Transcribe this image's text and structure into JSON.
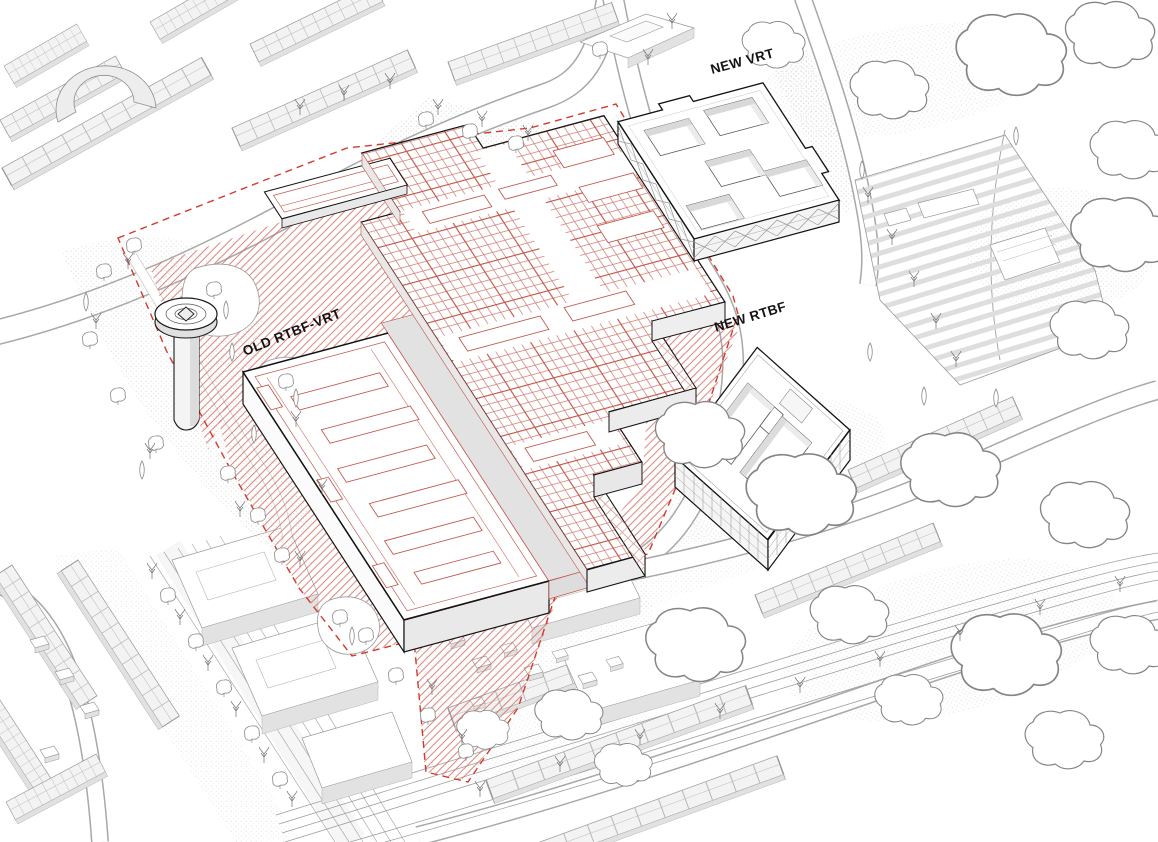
{
  "drawing": {
    "labels": {
      "new_vrt": "NEW VRT",
      "old_rtbf_vrt": "OLD RTBF-VRT",
      "new_rtbf": "NEW RTBF"
    },
    "colors": {
      "boundary_red": "#d13b2e",
      "hatch_red": "#d4655a",
      "grid_red": "#d4837b",
      "grid_red_major": "#c25648",
      "line_red": "#c0564a",
      "outline_black": "#141414",
      "context_gray": "#9a9a9a",
      "fill_light_gray": "#e6e6e6",
      "background": "#ffffff"
    }
  }
}
